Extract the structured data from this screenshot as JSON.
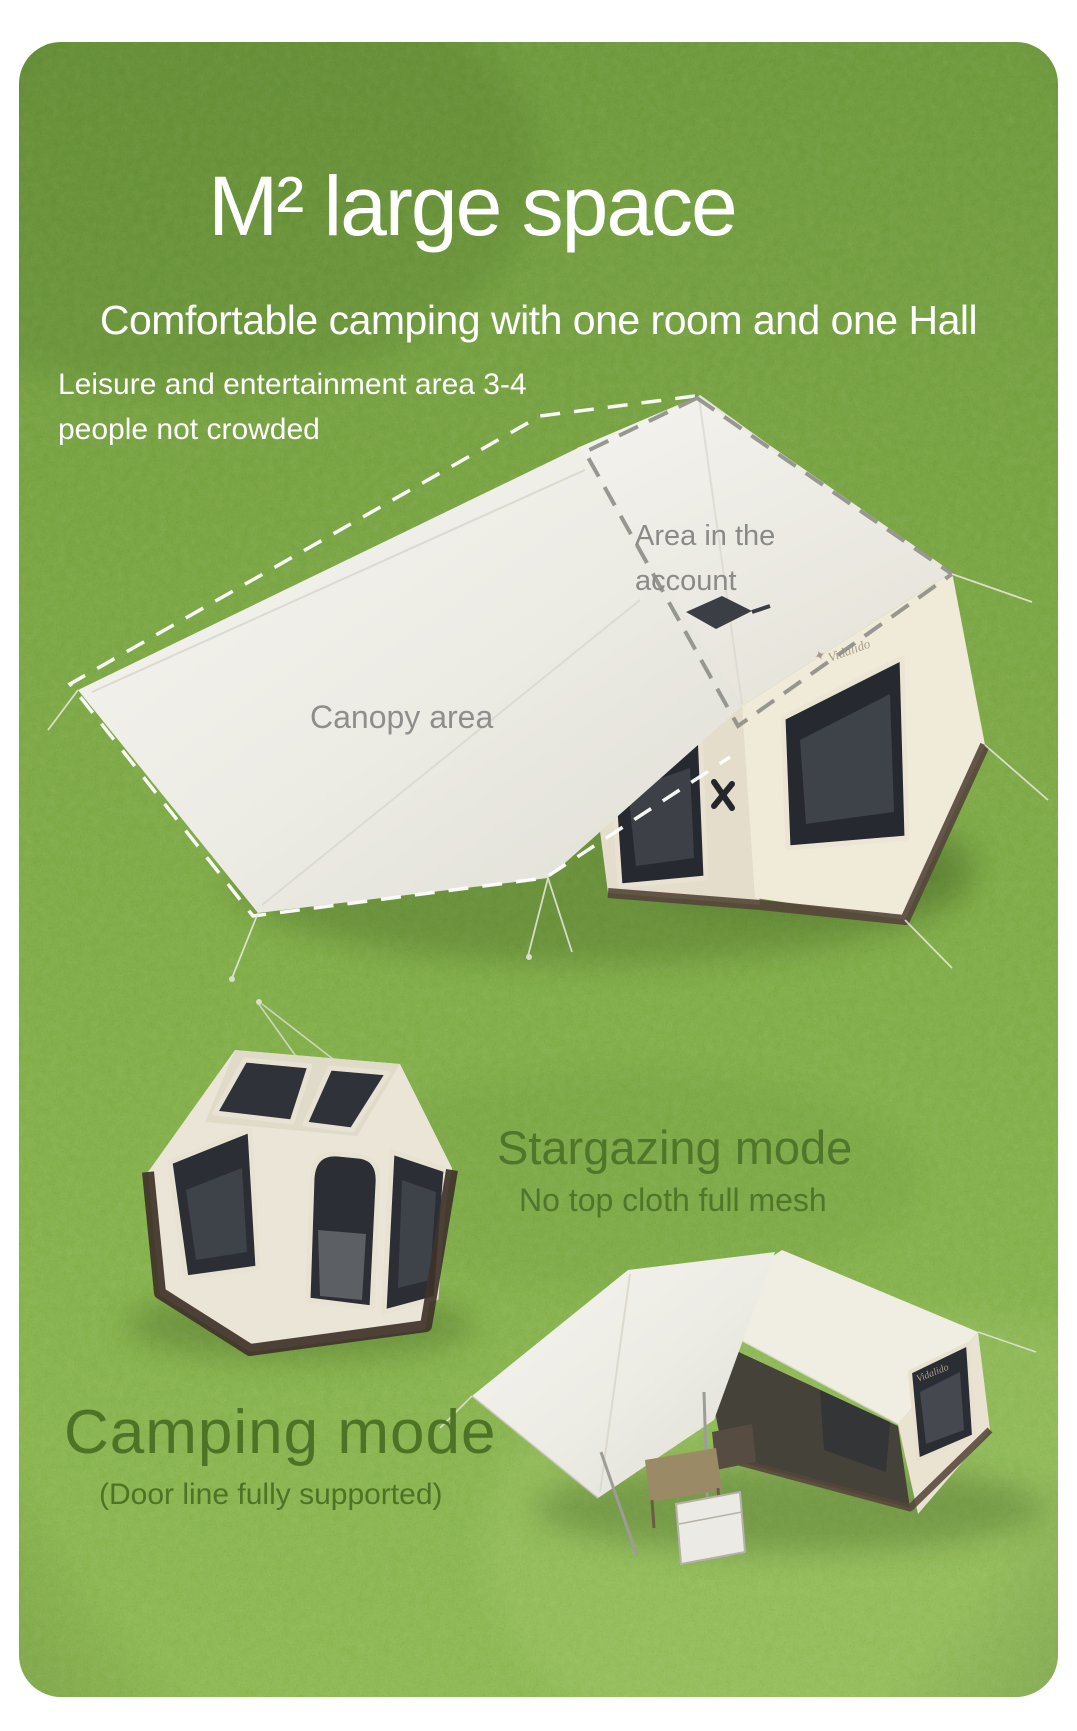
{
  "hero": {
    "title": "M² large space",
    "subtitle": "Comfortable camping with one room and one Hall",
    "note_line1": "Leisure and entertainment area 3-4",
    "note_line2": "people not crowded"
  },
  "diagram_labels": {
    "canopy_area": "Canopy area",
    "account_area_line1": "Area in the",
    "account_area_line2": "account"
  },
  "modes": {
    "stargazing_title": "Stargazing mode",
    "stargazing_subtitle": "No top cloth full mesh",
    "camping_title": "Camping mode",
    "camping_subtitle": "(Door line fully supported)"
  },
  "brand": {
    "logo_text": "Vidalido"
  },
  "colors": {
    "text_white": "#ffffff",
    "text_gray": "#8b8b89",
    "text_green": "#50762a",
    "grass_green": "#81af47",
    "tent_cream": "#efe9dc",
    "mesh_dark": "#2a2d33",
    "skirt_brown": "#4c3d30"
  }
}
